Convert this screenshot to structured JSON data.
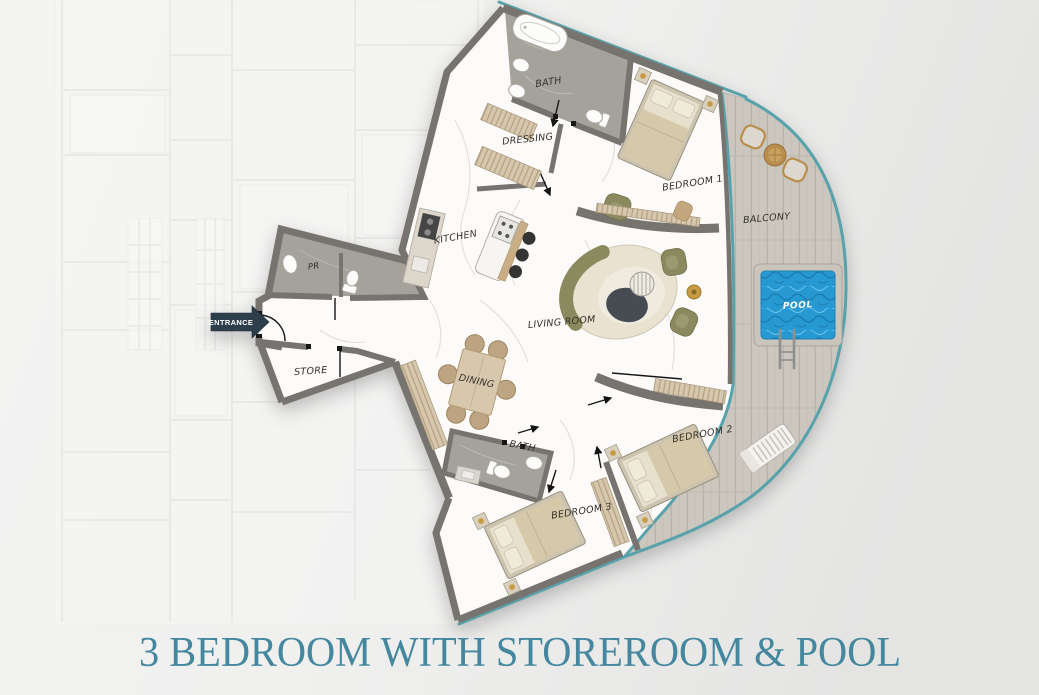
{
  "title": "3 BEDROOM WITH STOREROOM & POOL",
  "rooms": {
    "bath1": "BATH",
    "dressing": "DRESSING",
    "bedroom1": "BEDROOM 1",
    "kitchen": "KITCHEN",
    "living_room": "LIVING ROOM",
    "dining": "DINING",
    "bath2": "BATH",
    "bedroom3": "BEDROOM 3",
    "bedroom2": "BEDROOM 2",
    "pr": "PR",
    "store": "STORE",
    "balcony": "BALCONY",
    "pool": "POOL"
  },
  "entrance_label": "ENTRANCE",
  "colors": {
    "title_text": "#45879e",
    "outline_teal": "#58a2ab",
    "wall_gray": "#77746f",
    "tile_gray": "#a5a19b",
    "wood_deck": "#cbc7bf",
    "pool_water": "#2799d2",
    "olive": "#8a8a5e",
    "cream": "#e9e2d0",
    "wood_furniture": "#c9ad85",
    "entrance_navy": "#2e3f4c"
  }
}
